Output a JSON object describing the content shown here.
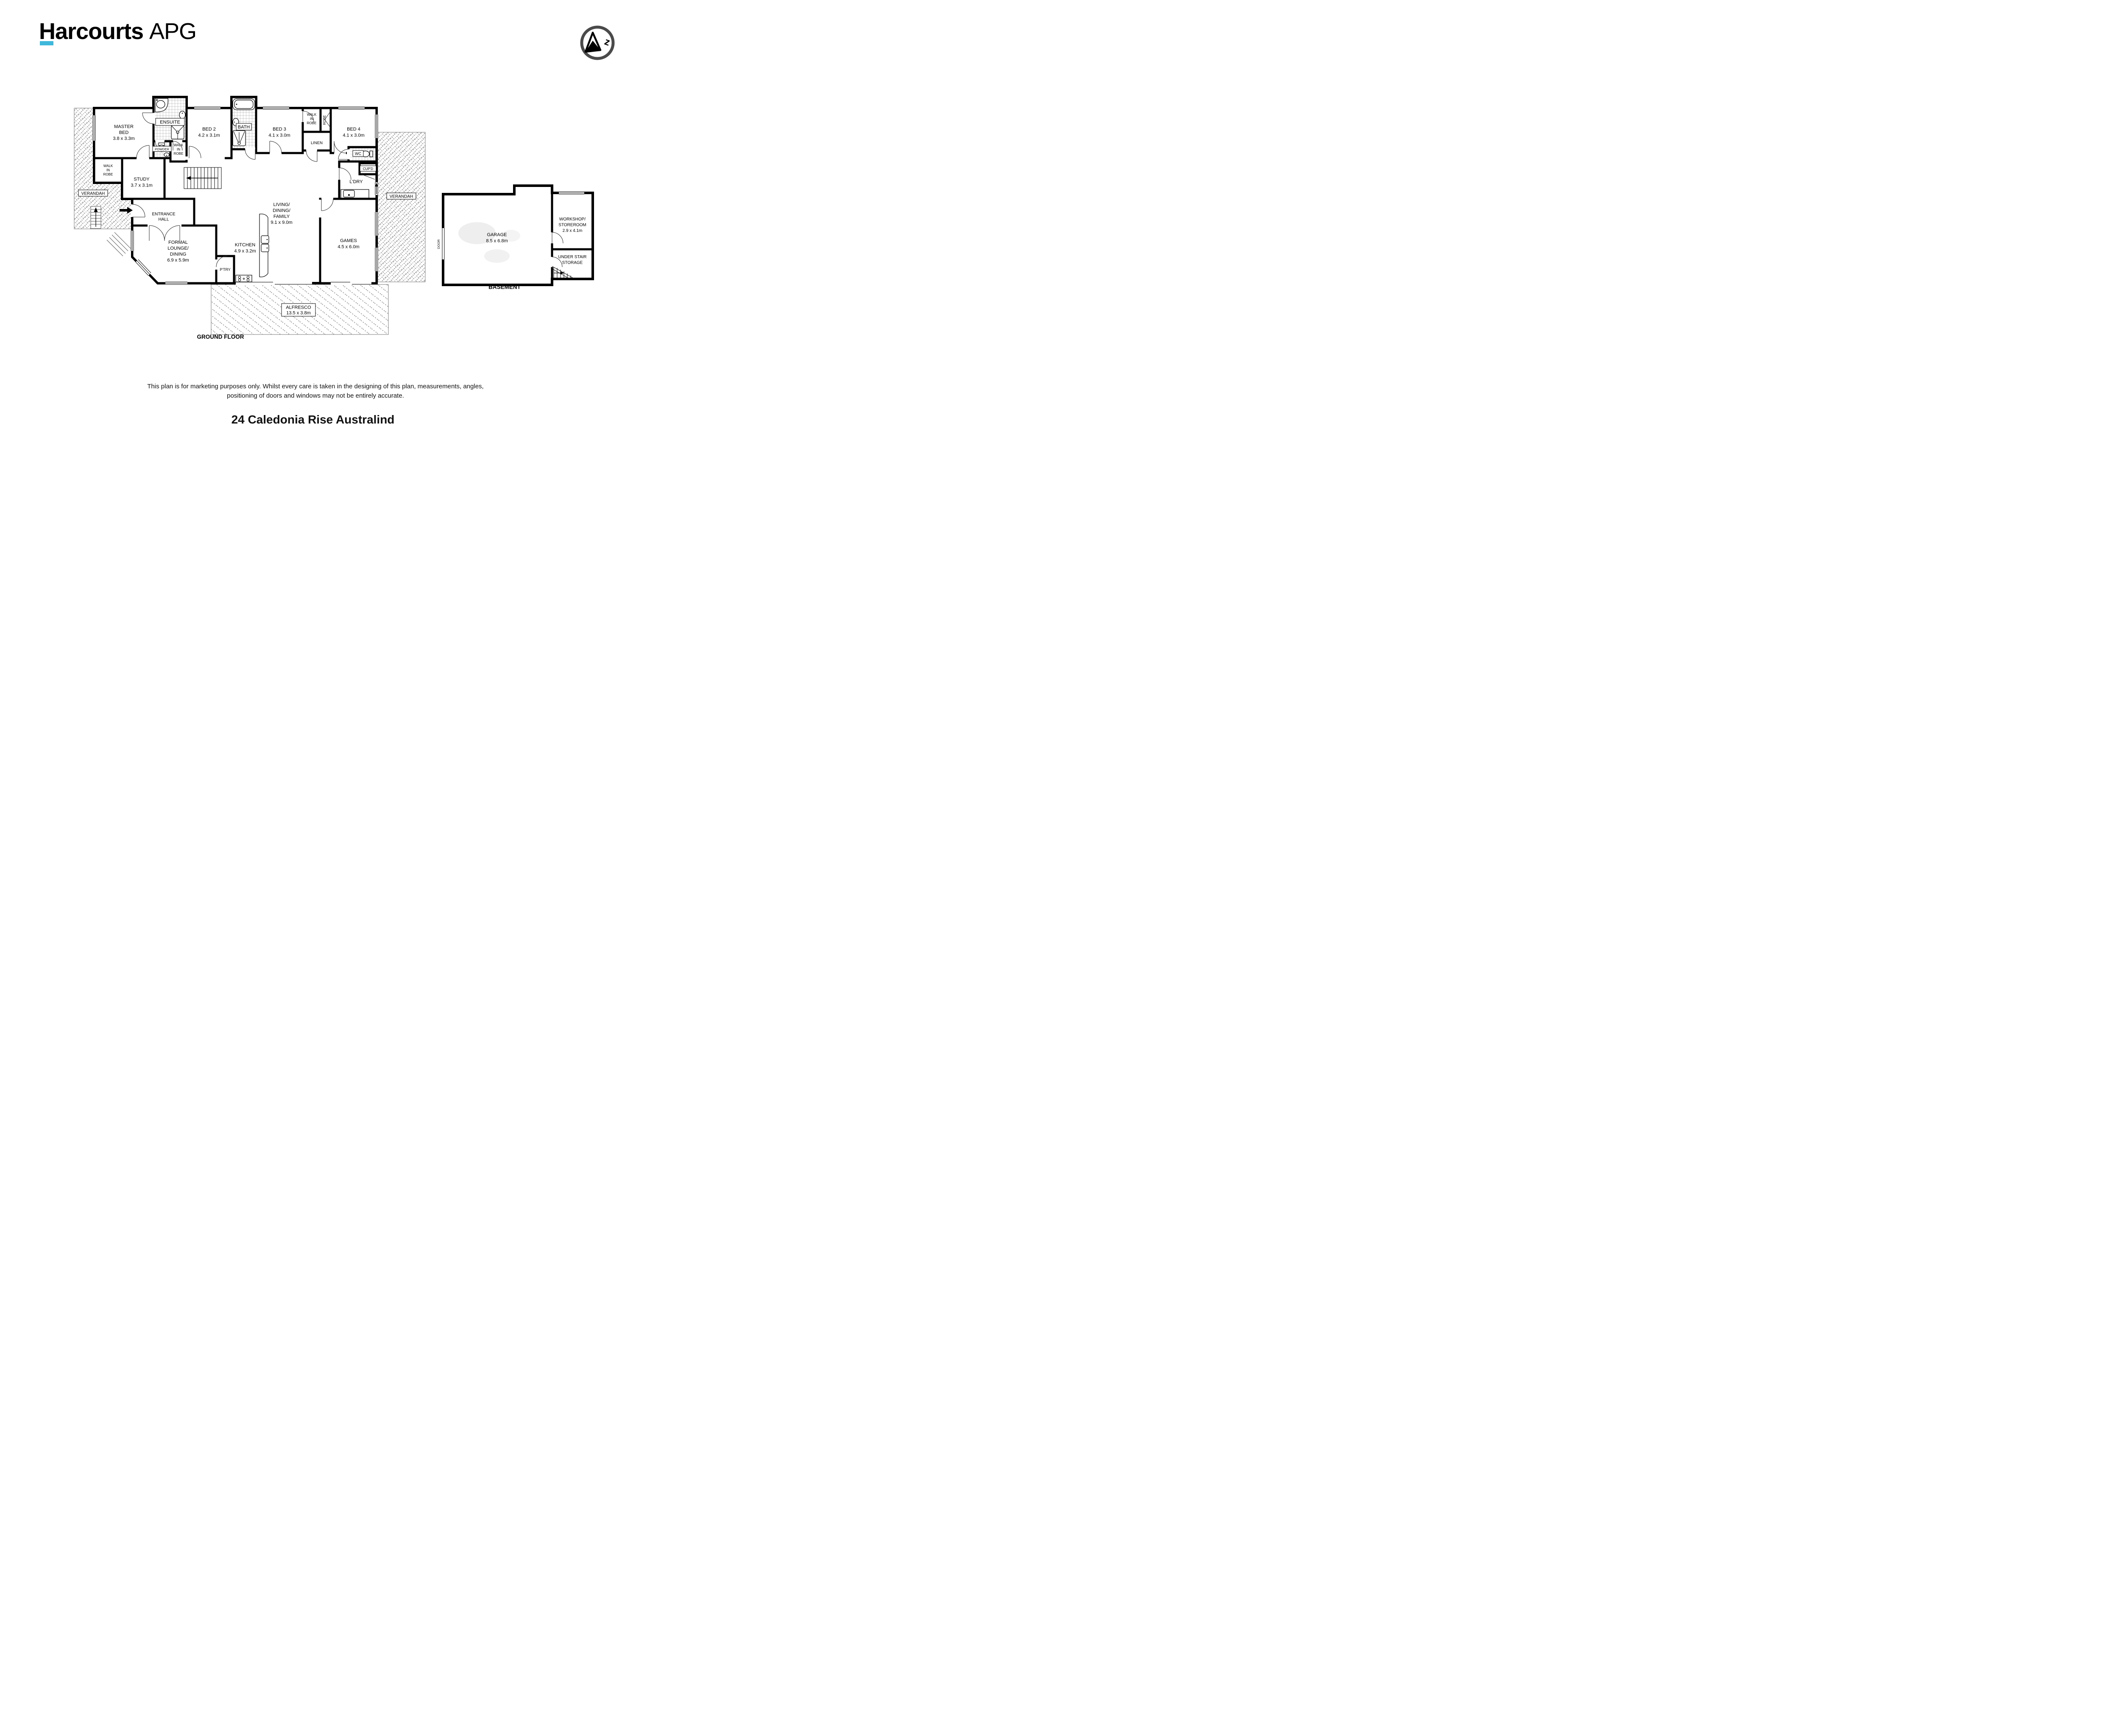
{
  "brand": {
    "primary": "Harcourts",
    "secondary": "APG",
    "navy": "#10265a",
    "cyan": "#3fb8dc"
  },
  "compass": {
    "letter": "z"
  },
  "rooms": {
    "master": [
      "MASTER",
      "BED",
      "3.8 x 3.3m"
    ],
    "ensuite": [
      "ENSUITE"
    ],
    "powder": [
      "POWDER"
    ],
    "wir": [
      "WALK",
      "IN",
      "ROBE"
    ],
    "robe": [
      "ROBE"
    ],
    "linen": [
      "LINEN"
    ],
    "bed2": [
      "BED 2",
      "4.2 x 3.1m"
    ],
    "bath": [
      "BATH"
    ],
    "bed3": [
      "BED 3",
      "4.1 x 3.0m"
    ],
    "bed4": [
      "BED 4",
      "4.1 x 3.0m"
    ],
    "wc": [
      "WC"
    ],
    "cupd": [
      "CUP'D"
    ],
    "ldry": [
      "L'DRY"
    ],
    "study": [
      "STUDY",
      "3.7 x 3.1m"
    ],
    "entrance": [
      "ENTRANCE",
      "HALL"
    ],
    "lounge": [
      "FORMAL",
      "LOUNGE/",
      "DINING",
      "6.9 x 5.9m"
    ],
    "kitchen": [
      "KITCHEN",
      "4.9 x 3.2m"
    ],
    "ptry": [
      "P'TRY"
    ],
    "living": [
      "LIVING/",
      "DINING/",
      "FAMILY",
      "9.1 x 9.0m"
    ],
    "games": [
      "GAMES",
      "4.5 x 6.0m"
    ],
    "alfresco": [
      "ALFRESCO",
      "13.5 x 3.8m"
    ],
    "verandah": [
      "VERANDAH"
    ],
    "garage": [
      "GARAGE",
      "8.5 x 6.8m"
    ],
    "door": [
      "DOOR"
    ],
    "workshop": [
      "WORKSHOP/",
      "STOREROOM",
      "2.9 x 4.1m"
    ],
    "under_stair": [
      "UNDER STAIR",
      "STORAGE"
    ]
  },
  "captions": {
    "ground": "GROUND FLOOR",
    "basement": "BASEMENT"
  },
  "disclaimer": {
    "line1": "This plan is for marketing purposes only. Whilst every care is taken in the designing of this plan, measurements, angles,",
    "line2": "positioning of doors and windows may not be entirely accurate."
  },
  "address": "24 Caledonia Rise Australind"
}
